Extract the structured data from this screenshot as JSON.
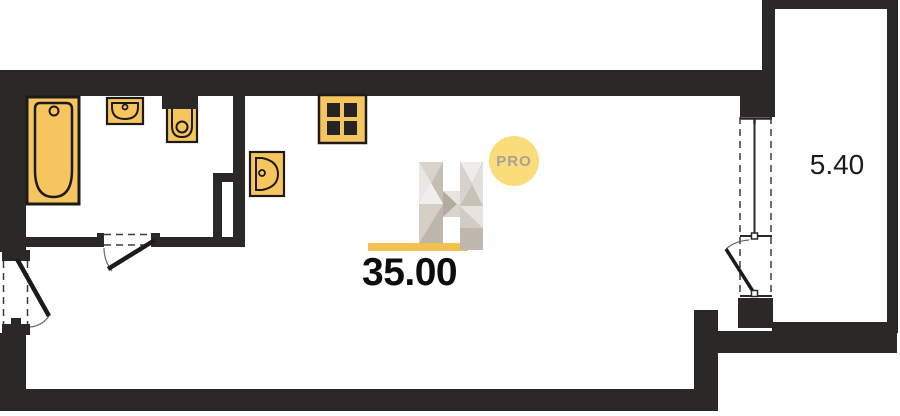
{
  "labels": {
    "main_area": "35.00",
    "balcony_area": "5.40"
  },
  "watermark": {
    "letter": "H",
    "badge": "PRO"
  },
  "fixtures": [
    {
      "name": "bathtub-icon"
    },
    {
      "name": "wall-sink-icon"
    },
    {
      "name": "toilet-icon"
    },
    {
      "name": "corner-sink-icon"
    },
    {
      "name": "stove-burners-icon"
    },
    {
      "name": "entrance-door-swing-icon"
    },
    {
      "name": "bathroom-door-swing-icon"
    },
    {
      "name": "balcony-window-door-icon"
    }
  ],
  "colors": {
    "wall": "#2b2927",
    "fixture_fill": "#f6c55f",
    "fixture_stroke": "#1d1b19",
    "accent_underline": "#f2c14e",
    "badge_fill": "#fbdc7a",
    "badge_text": "#a8a198",
    "area_text": "#0d0d0d",
    "dash_line": "#3c3c3c"
  }
}
